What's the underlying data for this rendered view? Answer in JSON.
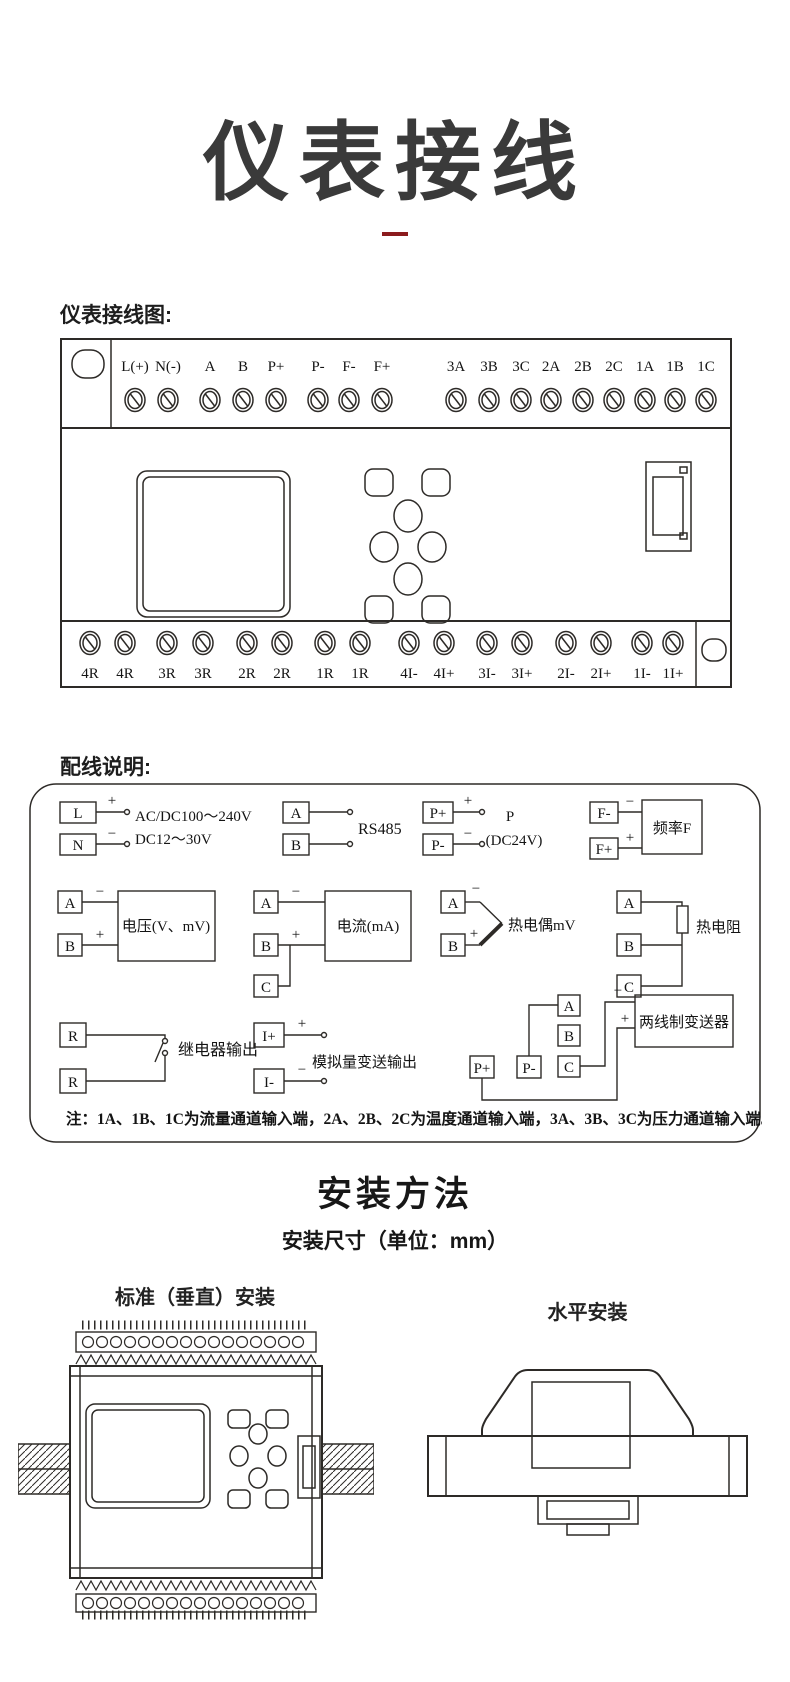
{
  "page": {
    "title": "仪表接线",
    "wiring_diagram_label": "仪表接线图:",
    "wiring_note_label": "配线说明:",
    "install_title": "安装方法",
    "install_subtitle": "安装尺寸（单位：mm）",
    "vertical_install_label": "标准（垂直）安装",
    "horizontal_install_label": "水平安装",
    "accent_color": "#8b1b1e"
  },
  "terminals": {
    "top": [
      "L(+)",
      "N(-)",
      "A",
      "B",
      "P+",
      "P-",
      "F-",
      "F+",
      "3A",
      "3B",
      "3C",
      "2A",
      "2B",
      "2C",
      "1A",
      "1B",
      "1C"
    ],
    "bottom": [
      "4R",
      "4R",
      "3R",
      "3R",
      "2R",
      "2R",
      "1R",
      "1R",
      "4I-",
      "4I+",
      "3I-",
      "3I+",
      "2I-",
      "2I+",
      "1I-",
      "1I+"
    ]
  },
  "wiring": {
    "plus": "+",
    "minus": "−",
    "power": {
      "t1": "L",
      "t2": "N",
      "line1": "AC/DC100～240V",
      "line2": "DC12～30V"
    },
    "rs485": {
      "t1": "A",
      "t2": "B",
      "label": "RS485"
    },
    "sensor_power": {
      "t1": "P+",
      "t2": "P-",
      "line1": "P",
      "line2": "(DC24V)"
    },
    "frequency": {
      "t1": "F-",
      "t2": "F+",
      "device": "频率F"
    },
    "voltage": {
      "t1": "A",
      "t2": "B",
      "device": "电压(V、mV)"
    },
    "current": {
      "t1": "A",
      "t2": "B",
      "t3": "C",
      "device": "电流(mA)"
    },
    "thermocouple": {
      "t1": "A",
      "t2": "B",
      "label": "热电偶mV"
    },
    "rtd": {
      "t1": "A",
      "t2": "B",
      "t3": "C",
      "label": "热电阻"
    },
    "relay": {
      "t1": "R",
      "t2": "R",
      "label": "继电器输出"
    },
    "analog_output": {
      "t1": "I+",
      "t2": "I-",
      "label": "模拟量变送输出"
    },
    "transmitter": {
      "p1": "P+",
      "p2": "P-",
      "t1": "A",
      "t2": "B",
      "t3": "C",
      "device": "两线制变送器"
    },
    "note": "注：1A、1B、1C为流量通道输入端，2A、2B、2C为温度通道输入端，3A、3B、3C为压力通道输入端。"
  }
}
